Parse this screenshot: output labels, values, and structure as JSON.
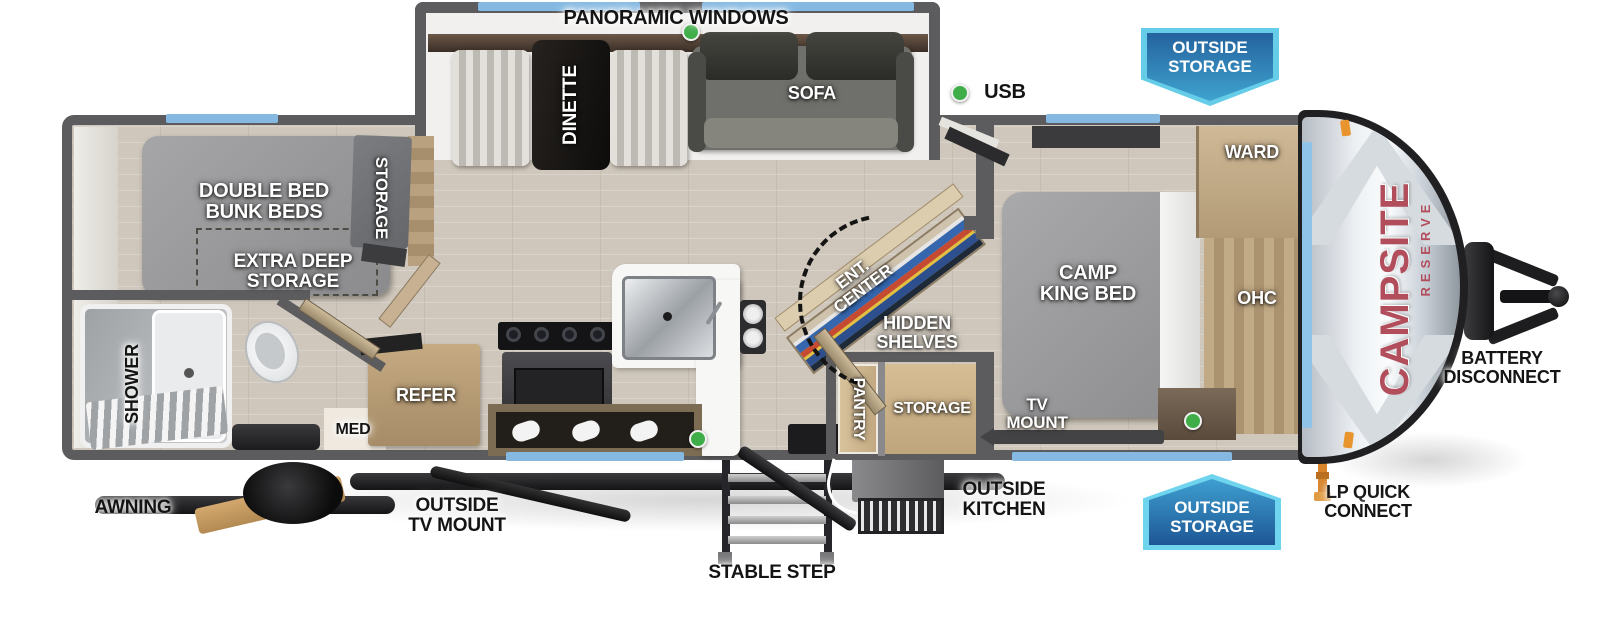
{
  "title": "Campsite Reserve travel trailer floorplan",
  "brand": {
    "name": "CAMPSITE",
    "sub": "RESERVE"
  },
  "badges": {
    "top": "OUTSIDE\nSTORAGE",
    "bottom": "OUTSIDE\nSTORAGE"
  },
  "labels": {
    "panoramic_windows": "PANORAMIC WINDOWS",
    "usb": "USB",
    "dinette": "DINETTE",
    "sofa": "SOFA",
    "double_bed_bunk_beds": "DOUBLE BED\nBUNK BEDS",
    "storage_bunk": "STORAGE",
    "extra_deep_storage": "EXTRA DEEP\nSTORAGE",
    "shower": "SHOWER",
    "med": "MED",
    "refer": "REFER",
    "ent_center": "ENT.\nCENTER",
    "hidden_shelves": "HIDDEN\nSHELVES",
    "pantry": "PANTRY",
    "storage_mid": "STORAGE",
    "camp_king_bed": "CAMP\nKING BED",
    "ward": "WARD",
    "ohc": "OHC",
    "tv_mount": "TV\nMOUNT",
    "awning": "AWNING",
    "outside_tv_mount": "OUTSIDE\nTV MOUNT",
    "stable_step": "STABLE STEP",
    "outside_kitchen": "OUTSIDE\nKITCHEN",
    "battery_disconnect": "BATTERY\nDISCONNECT",
    "lp_quick_connect": "LP QUICK\nCONNECT"
  },
  "colors": {
    "window_blue": "#85b9e2",
    "usb_green": "#3fae49",
    "wall_gray": "#5c5c5e",
    "badge_border": "#66cde9",
    "badge_blue_dark": "#1d5795",
    "badge_blue_light": "#3fa3cf",
    "brand_red": "#b24e5c"
  }
}
